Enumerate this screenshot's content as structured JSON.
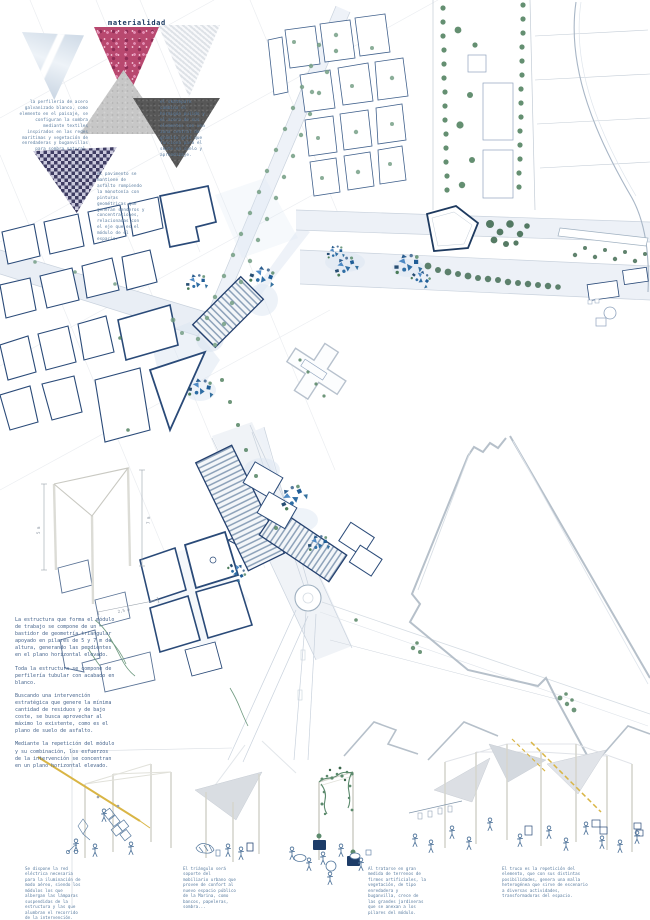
{
  "poster": {
    "title": "materialidad",
    "materiality": {
      "note_left": "la perfilería de acero galvanizado blanco, como elemento en el paisaje, se configuran la sombra mediante textiles inspirados en las redes marítimas y vegetación de enredaderas y buganvillas para sombra natural.",
      "note_right": "el skatepark combina el hormigón pulido y el acero de sus elementos con una zona central de granito gris que funciona para el skate en suelo y aprendizaje.",
      "note_bottom": "el pavimento se mantiene de asfalto rompiendo la monotonía con pinturas geométricas que generan senderos y concentraciones, relacionadas con el eje que es el módulo de el espacio.",
      "swatches": [
        "acero-galvanizado-foto",
        "buganvilla-flores",
        "textil-redes",
        "granito-hormigon",
        "asfalto",
        "patron-triangular-navy"
      ]
    },
    "module": {
      "dim_height_left": "5 m",
      "dim_height_right": "7 m",
      "dim_base": "2,5 m"
    },
    "structure": {
      "p1": "La estructura que forma el módulo de trabajo se compone de un bastidor de geometría triangular apoyado en pilares de 5 y 7 m de altura, generando las pendientes en el plano horizontal elevado.",
      "p2": "Toda la estructura se compone de perfilería tubular con acabado en blanco.",
      "p3": "Buscando una intervención estratégica que genere la mínima cantidad de residuos y de bajo coste, se busca aprovechar al máximo lo existente, como es el plano de suelo de asfalto.",
      "p4": "Mediante la repetición del módulo y su combinación, los esfuerzos de la intervención se concentran en un plano horizontal elevado."
    },
    "vignettes": [
      {
        "caption": "Se dispone la red eléctrica necesaria para la iluminación de modo aéreo, siendo los módulos los que albergan las lámparas suspendidas de la estructura y las que alumbran el recorrido de la intervención."
      },
      {
        "caption": "El triángulo será soporte del mobiliario urbano que provee de confort al nuevo espacio público de la Marina, como bancos, papeleras, sombra..."
      },
      {
        "caption": "Al tratarse en gran medida de terrenos de firmes artificiales, la vegetación, de tipo enredadera y buganvilla, crece de las grandes jardineras que se anexan a los pilares del módulo."
      },
      {
        "caption": "El truco es la repetición del elemento, que con sus distintas posibilidades, genera una malla heterogénea que sirve de escenario a diversas actividades, transformadoras del espacio."
      }
    ],
    "map": {
      "features": [
        "urban-blocks-west",
        "warehouse-sheds-hatched",
        "harbor-quays",
        "tree-lined-boulevard",
        "roundabout",
        "intervention-module-clusters",
        "pentagon-plaza",
        "beach-shoreline",
        "triangular-survey-grid"
      ]
    },
    "colors": {
      "navy": "#1e3a5f",
      "building_outline": "#2a4a78",
      "module_blue": "#2e6da4",
      "tree_green": "#4a7c59",
      "tree_green_dark": "#39654a",
      "road_fill": "#e9eef5",
      "quay_gray": "#b6c0ca",
      "grid_line": "#dbdfe5",
      "cable_yellow": "#d9b545",
      "flower_pink": "#b8486f",
      "asphalt_gray": "#575757",
      "pattern_navy": "#3f3d63"
    }
  }
}
